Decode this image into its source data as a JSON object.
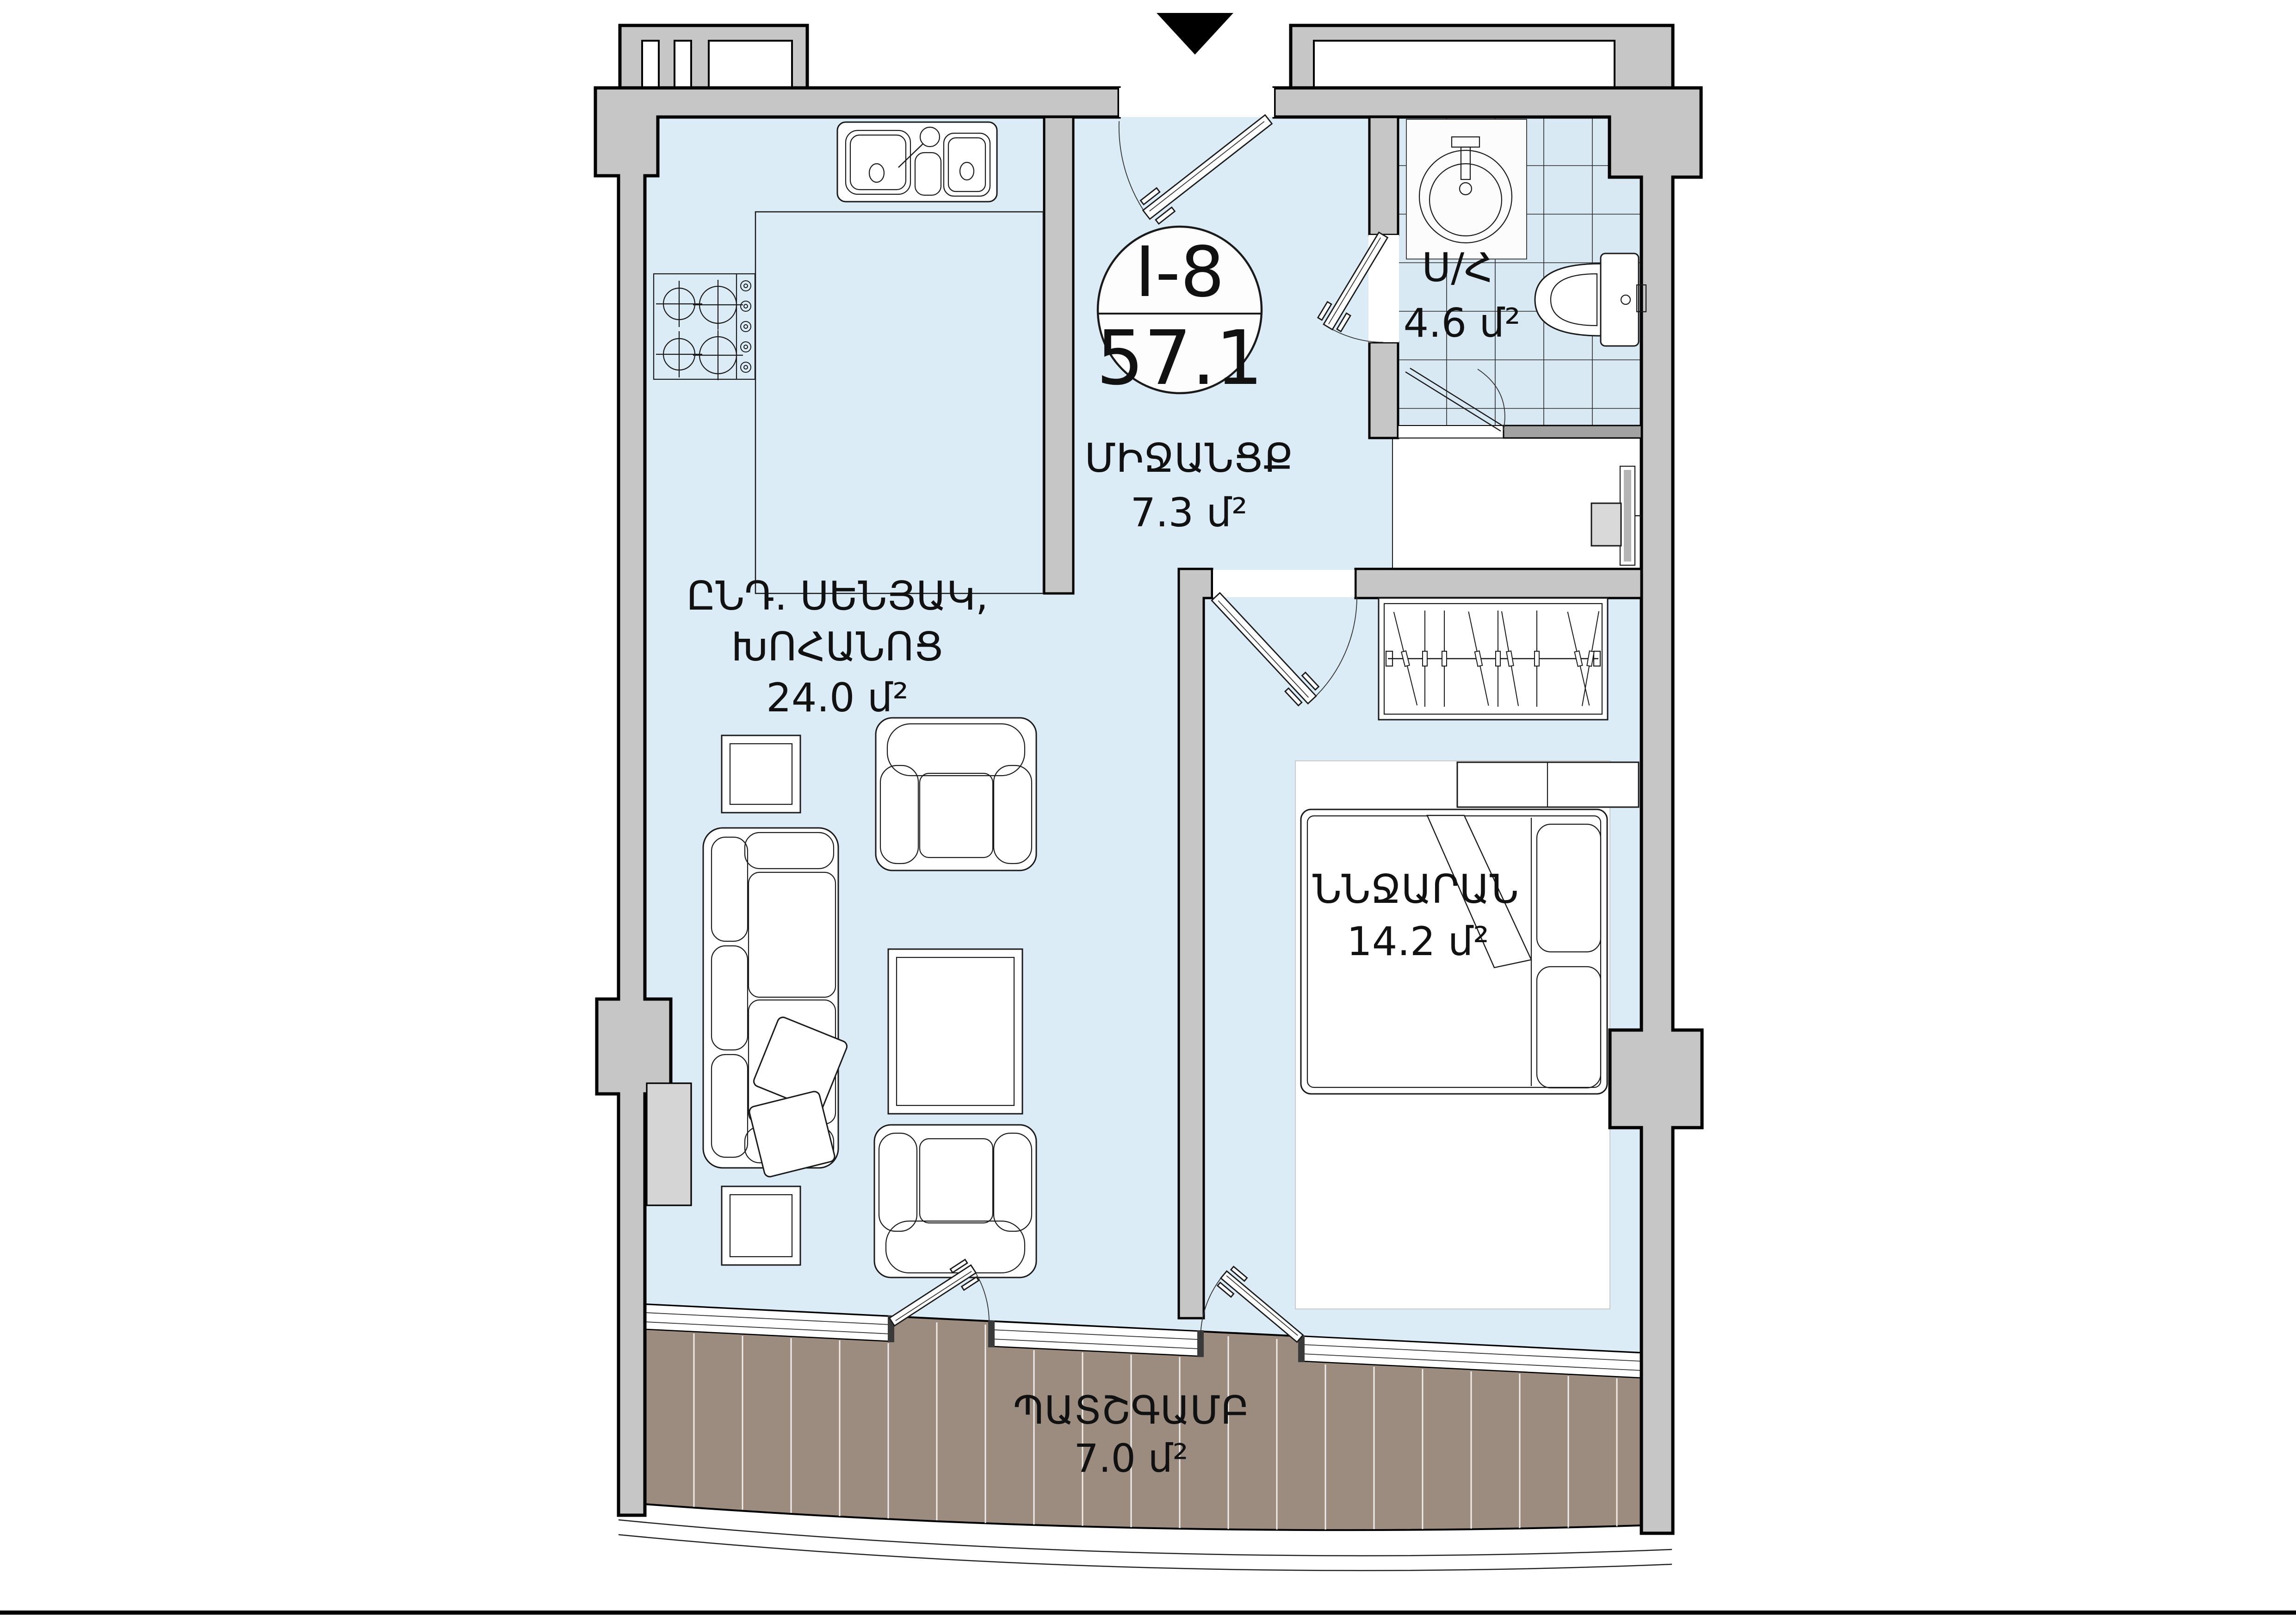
{
  "title": "Apartment floor plan",
  "unit": {
    "code": "I-8",
    "area": "57.1"
  },
  "rooms": {
    "hallway": {
      "name": "ՄԻՋԱՆՑՔ",
      "area": "7.3 մ²"
    },
    "bathroom": {
      "name": "Ս/Հ",
      "area": "4.6 մ²"
    },
    "living": {
      "name_line1": "ԸՆԴ. ՍԵՆՅԱԿ,",
      "name_line2": "ԽՈՀԱՆՈՑ",
      "area": "24.0 մ²"
    },
    "bedroom": {
      "name": "ՆՆՋԱՐԱՆ",
      "area": "14.2 մ²"
    },
    "balcony": {
      "name": "ՊԱՏՇԳԱՄԲ",
      "area": "7.0 մ²"
    }
  },
  "icons": {
    "entrance_marker": "triangle-down-icon"
  },
  "colors": {
    "floor": "#dcecf6",
    "tile_floor": "#d8e9f4",
    "wall": "#c6c6c6",
    "wall_dark": "#a2a2a2",
    "deck": "#9c8b7f",
    "outline": "#000000"
  }
}
